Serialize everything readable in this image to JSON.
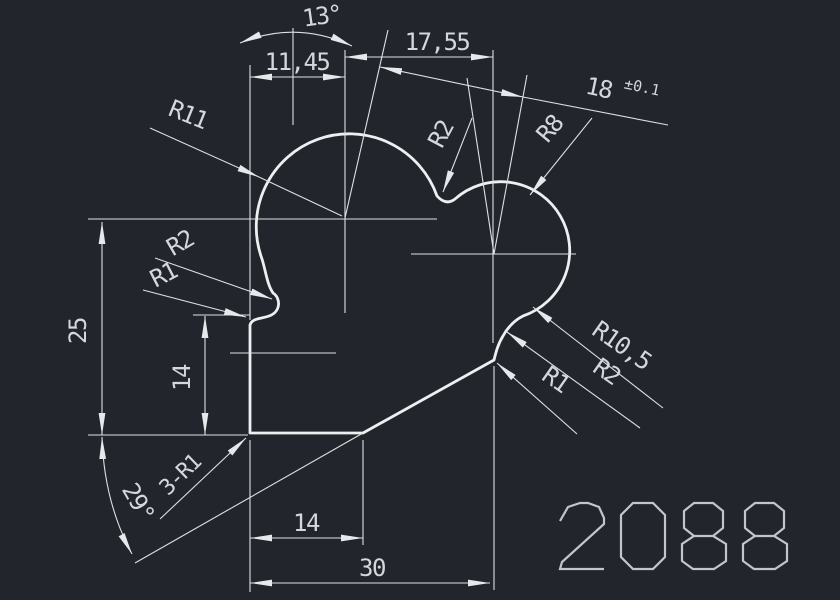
{
  "drawing": {
    "part_number": "2088",
    "colors": {
      "background": "#22262c",
      "profile_line": "#edeff1",
      "dimension_line": "#dde1e4",
      "text": "#d3d8dc",
      "part_number_text": "#c0c7cc"
    },
    "dims": {
      "angle_top": "13°",
      "width_upper_left": "11,45",
      "width_upper_right": "17,55",
      "center_distance": "18",
      "center_distance_tol": "±0.1",
      "radius_left_lobe": "R11",
      "radius_valley": "R2",
      "radius_right_lobe": "R8",
      "radius_left_notch_r2": "R2",
      "radius_left_notch_r1": "R1",
      "height_total": "25",
      "height_left_edge": "14",
      "radius_right_r105": "R10,5",
      "radius_right_r2": "R2",
      "radius_right_r1": "R1",
      "angle_bottom": "29°",
      "fillet_note": "3-R1",
      "width_bottom_inner": "14",
      "width_bottom_total": "30"
    }
  }
}
